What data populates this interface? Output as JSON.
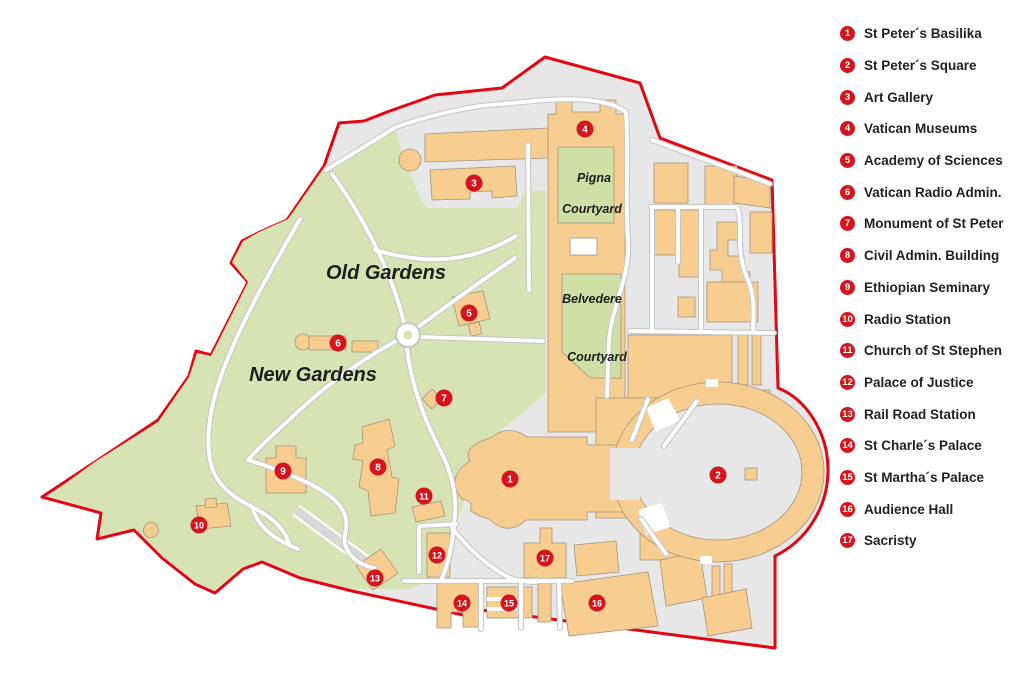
{
  "legend": {
    "items": [
      {
        "num": "1",
        "label": "St Peter´s Basilika"
      },
      {
        "num": "2",
        "label": "St Peter´s Square"
      },
      {
        "num": "3",
        "label": "Art Gallery"
      },
      {
        "num": "4",
        "label": "Vatican Museums"
      },
      {
        "num": "5",
        "label": "Academy of Sciences"
      },
      {
        "num": "6",
        "label": "Vatican Radio Admin."
      },
      {
        "num": "7",
        "label": "Monument of St Peter"
      },
      {
        "num": "8",
        "label": "Civil Admin. Building"
      },
      {
        "num": "9",
        "label": "Ethiopian Seminary"
      },
      {
        "num": "10",
        "label": "Radio Station"
      },
      {
        "num": "11",
        "label": "Church of St Stephen"
      },
      {
        "num": "12",
        "label": "Palace of Justice"
      },
      {
        "num": "13",
        "label": "Rail Road Station"
      },
      {
        "num": "14",
        "label": "St Charle´s Palace"
      },
      {
        "num": "15",
        "label": "St Martha´s Palace"
      },
      {
        "num": "16",
        "label": "Audience Hall"
      },
      {
        "num": "17",
        "label": "Sacristy"
      }
    ]
  },
  "map": {
    "markers": [
      {
        "num": "1",
        "x": 510,
        "y": 479
      },
      {
        "num": "2",
        "x": 718,
        "y": 475
      },
      {
        "num": "3",
        "x": 474,
        "y": 183
      },
      {
        "num": "4",
        "x": 585,
        "y": 129
      },
      {
        "num": "5",
        "x": 469,
        "y": 313
      },
      {
        "num": "6",
        "x": 338,
        "y": 343
      },
      {
        "num": "7",
        "x": 444,
        "y": 398
      },
      {
        "num": "8",
        "x": 378,
        "y": 467
      },
      {
        "num": "9",
        "x": 283,
        "y": 471
      },
      {
        "num": "10",
        "x": 199,
        "y": 525
      },
      {
        "num": "11",
        "x": 424,
        "y": 496
      },
      {
        "num": "12",
        "x": 437,
        "y": 555
      },
      {
        "num": "13",
        "x": 375,
        "y": 578
      },
      {
        "num": "14",
        "x": 462,
        "y": 603
      },
      {
        "num": "15",
        "x": 509,
        "y": 603
      },
      {
        "num": "16",
        "x": 597,
        "y": 603
      },
      {
        "num": "17",
        "x": 545,
        "y": 558
      }
    ],
    "labels": [
      {
        "text": "Old Gardens",
        "x": 386,
        "y": 279,
        "size": 20
      },
      {
        "text": "New Gardens",
        "x": 313,
        "y": 381,
        "size": 20
      },
      {
        "text": "Pigna",
        "x": 594,
        "y": 182,
        "size": 12.5
      },
      {
        "text": "Courtyard",
        "x": 592,
        "y": 213,
        "size": 12.5
      },
      {
        "text": "Belvedere",
        "x": 592,
        "y": 303,
        "size": 12.5
      },
      {
        "text": "Courtyard",
        "x": 597,
        "y": 361,
        "size": 12.5
      }
    ]
  },
  "colors": {
    "boundary_red": "#e30613",
    "marker_red": "#d5151d",
    "garden_green": "#d8e3b4",
    "courtyard_green": "#cfdfa6",
    "building_orange": "#f8ce90",
    "base_gray": "#e7e7e7",
    "path_white": "#ffffff"
  }
}
